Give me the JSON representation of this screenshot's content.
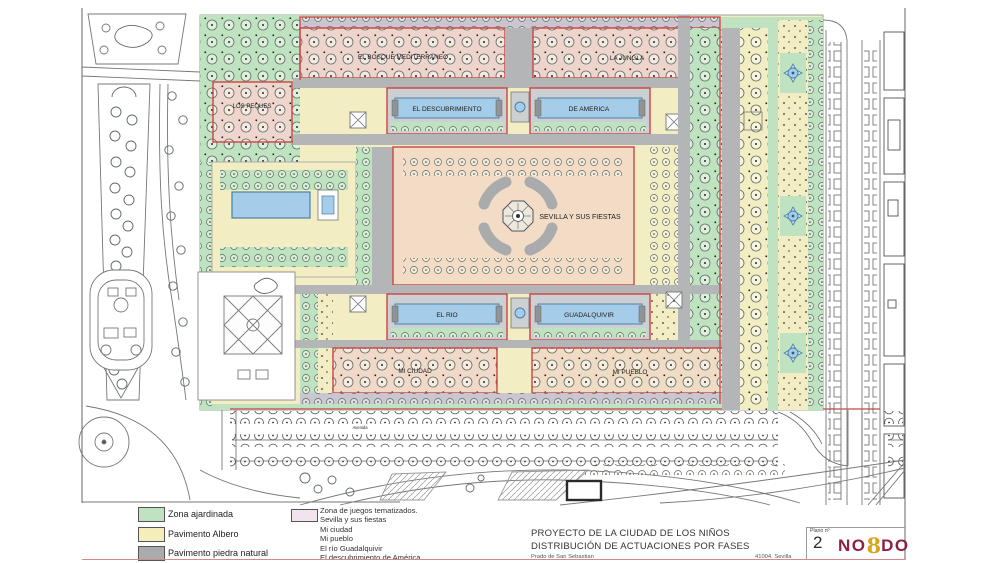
{
  "map": {
    "zones": {
      "bosque": "EL BOSQUE MEDITERRANEO",
      "jungla": "LA JUNGLA",
      "descubrimiento": "EL DESCUBRIMIENTO",
      "america": "DE AMERICA",
      "peques": "LOS PEQUES",
      "sevilla": "SEVILLA Y SUS FIESTAS",
      "rio": "EL RIO",
      "guadalquivir": "GUADALQUIVIR",
      "ciudad": "MI CIUDAD",
      "pueblo": "MI PUEBLO"
    },
    "street_label": "Avenida",
    "colors": {
      "garden_green": "#bfe3c1",
      "albero_yellow": "#f3edc3",
      "stone_gray": "#b3b5b7",
      "lavender_pavement": "#c9c6d2",
      "themed_pink": "#edd4cc",
      "plaza_peach": "#f3dcc6",
      "water_blue": "#a5cce8",
      "phase_outline_red": "#cc4444"
    }
  },
  "legend": {
    "items": [
      {
        "label": "Zona ajardinada",
        "color": "#bfe3c1"
      },
      {
        "label": "Pavimento Albero",
        "color": "#f5eebb"
      },
      {
        "label": "Pavimento piedra natural",
        "color": "#a9abad"
      }
    ],
    "themed": {
      "swatch_color": "#f1e4ee",
      "title": "Zona de juegos tematizados.",
      "items": [
        "Sevilla y sus fiestas",
        "Mi ciudad",
        "Mi pueblo",
        "El río Guadalquivir",
        "El descubrimiento de América"
      ]
    }
  },
  "titleblock": {
    "title1": "PROYECTO DE LA CIUDAD DE LOS NIÑOS",
    "title2": "DISTRIBUCIÓN DE ACTUACIONES POR FASES",
    "address": "Prado de San Sebastian",
    "city": "41004. Sevilla",
    "plan_label": "Plano nº",
    "plan_number": "2",
    "logo": {
      "left": "NO",
      "mid": "8",
      "right": "DO",
      "color": "#8e2043",
      "accent": "#d9a41e"
    }
  }
}
